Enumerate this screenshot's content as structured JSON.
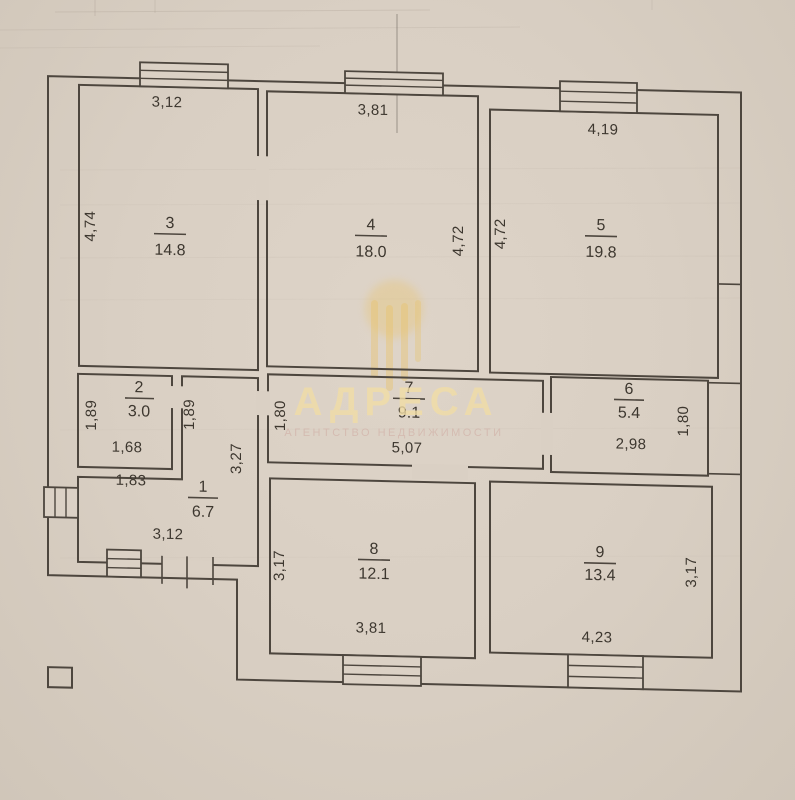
{
  "document": {
    "type": "apartment floor plan scan",
    "paper_color": "#d9cfc3",
    "line_color": "#4d463e"
  },
  "watermark": {
    "brand": "АДРЕСА",
    "tagline": "АГЕНТСТВО НЕДВИЖИМОСТИ",
    "brand_color": "#f1dda6",
    "tagline_color": "#cfa9a0",
    "emblem": "gold dome with hanging strands"
  },
  "plan": {
    "rooms": [
      {
        "number": "1",
        "area": "6.7",
        "w_top": "1,83",
        "h_right": "3,27",
        "w_bottom": "3,12"
      },
      {
        "number": "2",
        "area": "3.0",
        "h_left": "1,89",
        "h_right": "1,89",
        "w_bottom": "1,68"
      },
      {
        "number": "3",
        "area": "14.8",
        "w_top": "3,12",
        "h_left": "4,74"
      },
      {
        "number": "4",
        "area": "18.0",
        "w_top": "3,81",
        "h_right": "4,72"
      },
      {
        "number": "5",
        "area": "19.8",
        "w_top": "4,19",
        "h_left": "4,72"
      },
      {
        "number": "6",
        "area": "5.4",
        "w_bottom": "2,98",
        "h_right": "1,80"
      },
      {
        "number": "7",
        "area": "9.1",
        "h_left": "1,80",
        "w_bottom": "5,07"
      },
      {
        "number": "8",
        "area": "12.1",
        "h_left": "3,17",
        "w_bottom": "3,81"
      },
      {
        "number": "9",
        "area": "13.4",
        "w_bottom": "4,23",
        "h_right": "3,17"
      }
    ]
  }
}
